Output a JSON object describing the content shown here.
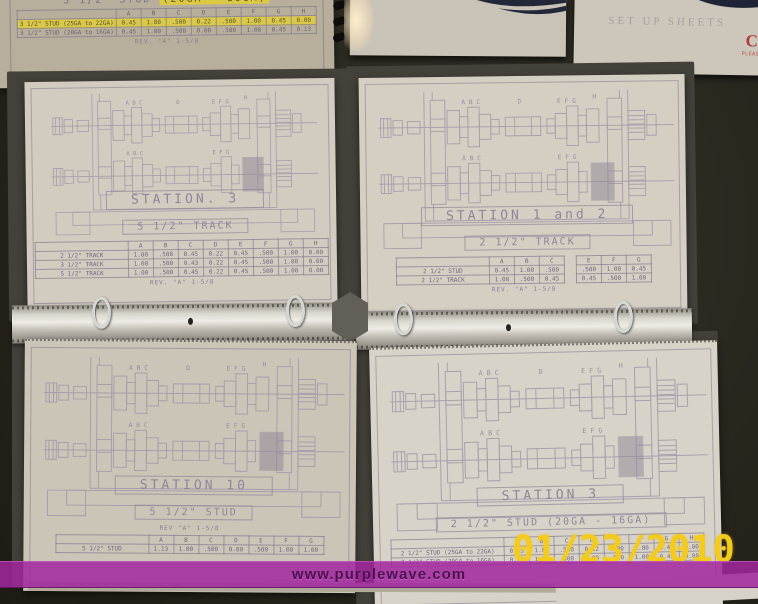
{
  "banner": {
    "text": "www.purplewave.com",
    "bg_color": "#a2279f",
    "text_color": "#4d1150"
  },
  "date_stamp": {
    "text": "01/23/2010",
    "color": "#f2cb1c"
  },
  "drawing_labels": {
    "left_group": "A B C",
    "center": "D",
    "right_group": "E F G",
    "end": "H"
  },
  "top_left_sheet": {
    "title_plain": "3 1/2\" STUD",
    "title_highlight": "(20GA - 16GA)",
    "table": {
      "headers": [
        "",
        "A",
        "B",
        "C",
        "D",
        "E",
        "F",
        "G",
        "H"
      ],
      "rows": [
        {
          "label": "3 1/2\" STUD (25GA to 22GA)",
          "values": [
            "0.45",
            "1.00",
            ".500",
            "0.22",
            ".500",
            "1.00",
            "0.45",
            "0.00"
          ],
          "highlighted": true
        },
        {
          "label": "3 1/2\" STUD (20GA to 16GA)",
          "values": [
            "0.45",
            "1.00",
            ".500",
            "0.00",
            ".500",
            "1.00",
            "0.45",
            "0.13"
          ],
          "highlighted": false
        }
      ]
    },
    "rev": "REV. \"A\" 1-5/8"
  },
  "top_right_binder": {
    "faint_title": "SET UP SHEETS",
    "red_letter": "C",
    "red_note": "PLEASE R"
  },
  "pages": {
    "middle_left": {
      "station": "STATION. 3",
      "size": "5 1/2\" TRACK",
      "table": {
        "headers": [
          "",
          "A",
          "B",
          "C",
          "D",
          "E",
          "F",
          "G",
          "H"
        ],
        "rows": [
          {
            "label": "2 1/2\" TRACK",
            "values": [
              "1.00",
              ".500",
              "0.45",
              "0.22",
              "0.45",
              ".500",
              "1.00",
              "0.00"
            ],
            "highlighted": false
          },
          {
            "label": "3 1/2\" TRACK",
            "values": [
              "1.00",
              ".500",
              "0.43",
              "0.22",
              "0.45",
              ".500",
              "1.00",
              "0.00"
            ],
            "highlighted": false
          },
          {
            "label": "5 1/2\" TRACK",
            "values": [
              "1.00",
              ".500",
              "0.45",
              "0.22",
              "0.45",
              ".500",
              "1.00",
              "0.00"
            ],
            "highlighted": false
          }
        ]
      },
      "rev": "REV. \"A\" 1-5/8"
    },
    "middle_right": {
      "station": "STATION 1 and 2",
      "size": "2 1/2\" TRACK",
      "table": {
        "headers": [
          "",
          "A",
          "B",
          "C",
          "",
          "E",
          "F",
          "G"
        ],
        "rows": [
          {
            "label": "2 1/2\" STUD",
            "values": [
              "0.45",
              "1.00",
              ".500",
              "",
              ".500",
              "1.00",
              "0.45"
            ],
            "highlighted": false
          },
          {
            "label": "2 1/2\" TRACK",
            "values": [
              "1.00",
              ".500",
              "0.45",
              "",
              "0.45",
              ".500",
              "1.00"
            ],
            "highlighted": false
          }
        ]
      },
      "rev": "REV. \"A\" 1-5/8"
    },
    "bottom_left": {
      "station": "STATION 10",
      "size": "5 1/2\" STUD",
      "rev": "REV \"A\" 1-5/8",
      "table": {
        "headers": [
          "",
          "A",
          "B",
          "C",
          "D",
          "E",
          "F",
          "G"
        ],
        "rows": [
          {
            "label": "5 1/2\" STUD",
            "values": [
              "1.13",
              "1.00",
              ".500",
              "0.00",
              ".500",
              "1.00",
              "1.00"
            ],
            "highlighted": false
          }
        ]
      }
    },
    "bottom_right": {
      "station": "STATION 3",
      "size": "2 1/2\" STUD (20GA - 16GA)",
      "table": {
        "headers": [
          "",
          "A",
          "B",
          "C",
          "D",
          "E",
          "F",
          "G",
          "H"
        ],
        "rows": [
          {
            "label": "2 1/2\" STUD (25GA to 22GA)",
            "values": [
              "0.45",
              "1.00",
              ".500",
              "0.22",
              ".500",
              "1.00",
              "0.45",
              "0.00"
            ],
            "highlighted": false
          },
          {
            "label": "2 1/2\" STUD (20GA to 16GA)",
            "values": [
              "0.45",
              "1.00",
              ".500",
              "0.00",
              ".500",
              "1.00",
              "0.45",
              "0.00"
            ],
            "highlighted": false
          }
        ]
      }
    }
  }
}
